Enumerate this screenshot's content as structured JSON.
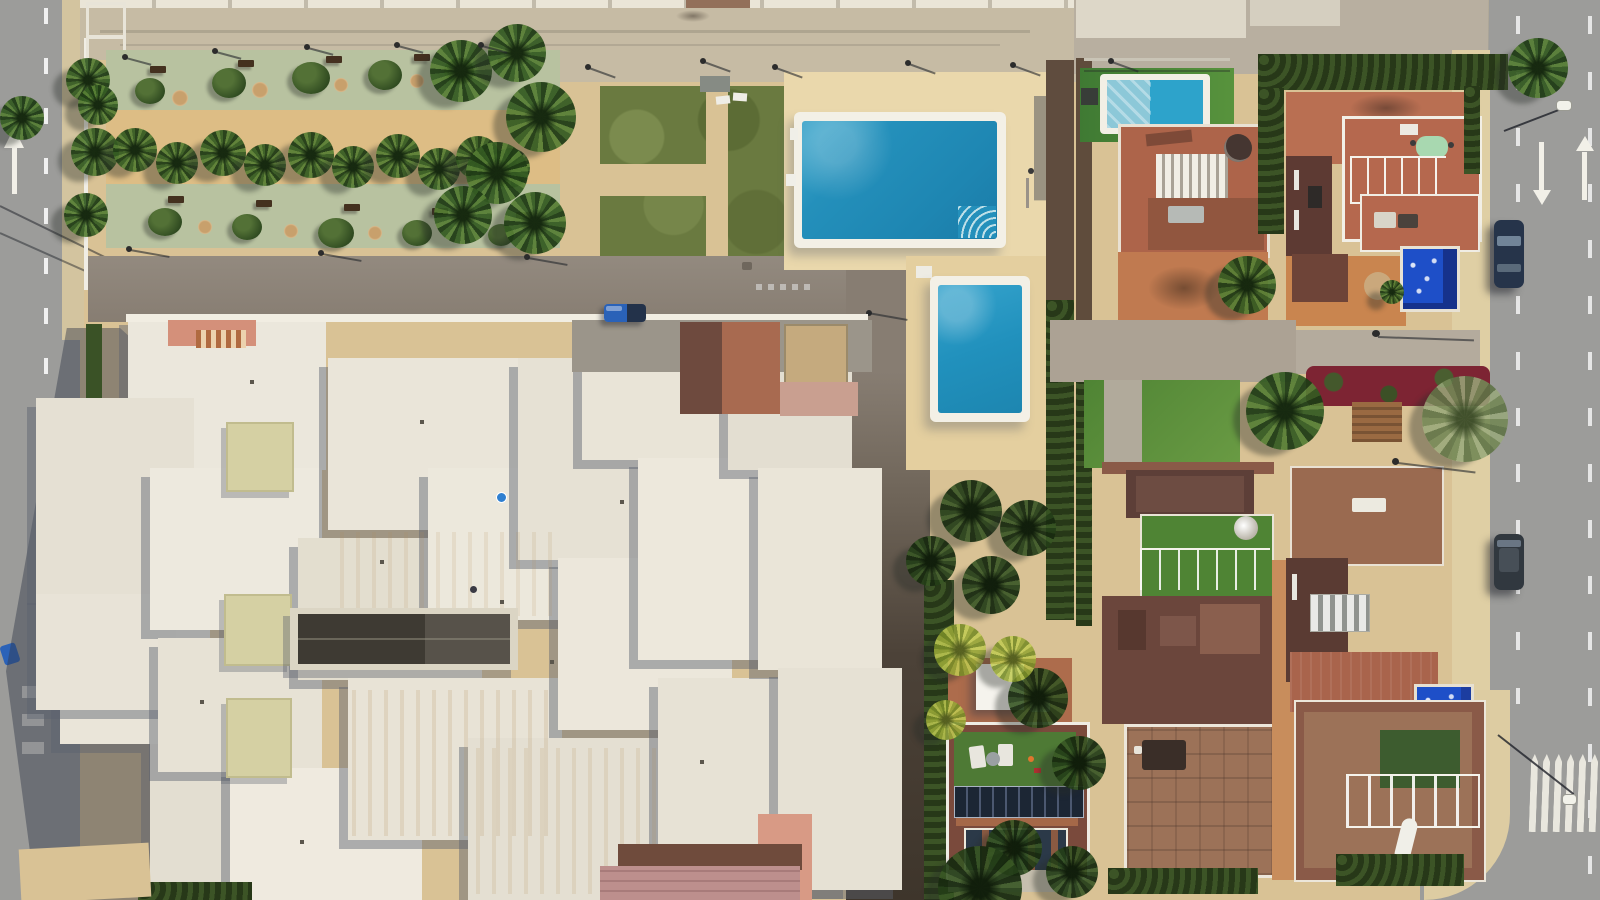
{
  "meta": {
    "title": "Aerial drone view of coastal residential block",
    "description": "Top-down aerial photograph: white flat-roofed apartment complex at left, palm-lined promenade park at top left, community lawn with large and small swimming pools in the centre, terracotta villas with roof terraces, railings, artificial grass, solar panels and private pools at right, bordered by asphalt streets with lane arrows, a pedestrian crossing and parked cars."
  },
  "palette": {
    "sand": "#d9c295",
    "sandPath": "#ddbd85",
    "sandDeck": "#ead8ac",
    "street": "#c6bba4",
    "road": "#9c9c9a",
    "sage": "#b8c2a0",
    "grass": "#6a7a40",
    "grassBright": "#4f8434",
    "hedgeGreen": "#32441f",
    "roofWhite": "#e9e5da",
    "skylight": "#d5d0a3",
    "driveGray": "#8d8378",
    "driveDark": "#3e352b",
    "poolBlue": "#2490bb",
    "poolRoyal": "#1e4fc8",
    "poolCover": "#8cc8d8",
    "terracotta": "#ad644a",
    "maroon": "#5d3a33",
    "salmon": "#d4907a",
    "solarPanel": "#1c2634",
    "carBlue": "#2a62b8",
    "carDark": "#26344a",
    "markingWhite": "#f2f0e8"
  },
  "scene": {
    "park": {
      "palm_trees": 21,
      "benches": 10,
      "walkways": 2,
      "lamp_posts": 8
    },
    "pools": {
      "community_large": 1,
      "community_small": 1,
      "villa_pools": 3,
      "covered_pool": 1
    },
    "apartment_complex": {
      "roof_blocks": 20,
      "skylights": 3,
      "dark_skylight_strips": 1
    },
    "villas": {
      "count": 6,
      "features": [
        "roof-terraces",
        "white-railings",
        "artificial-grass",
        "solar-panels",
        "sun-loungers",
        "pergolas"
      ]
    },
    "vehicles": {
      "blue_car": 1,
      "dark_parked_cars": 2
    },
    "road_markings": [
      "dashed-lane-lines",
      "straight-arrow",
      "up-arrow",
      "down-arrow",
      "pedestrian-crossing",
      "give-way-dashes"
    ]
  }
}
